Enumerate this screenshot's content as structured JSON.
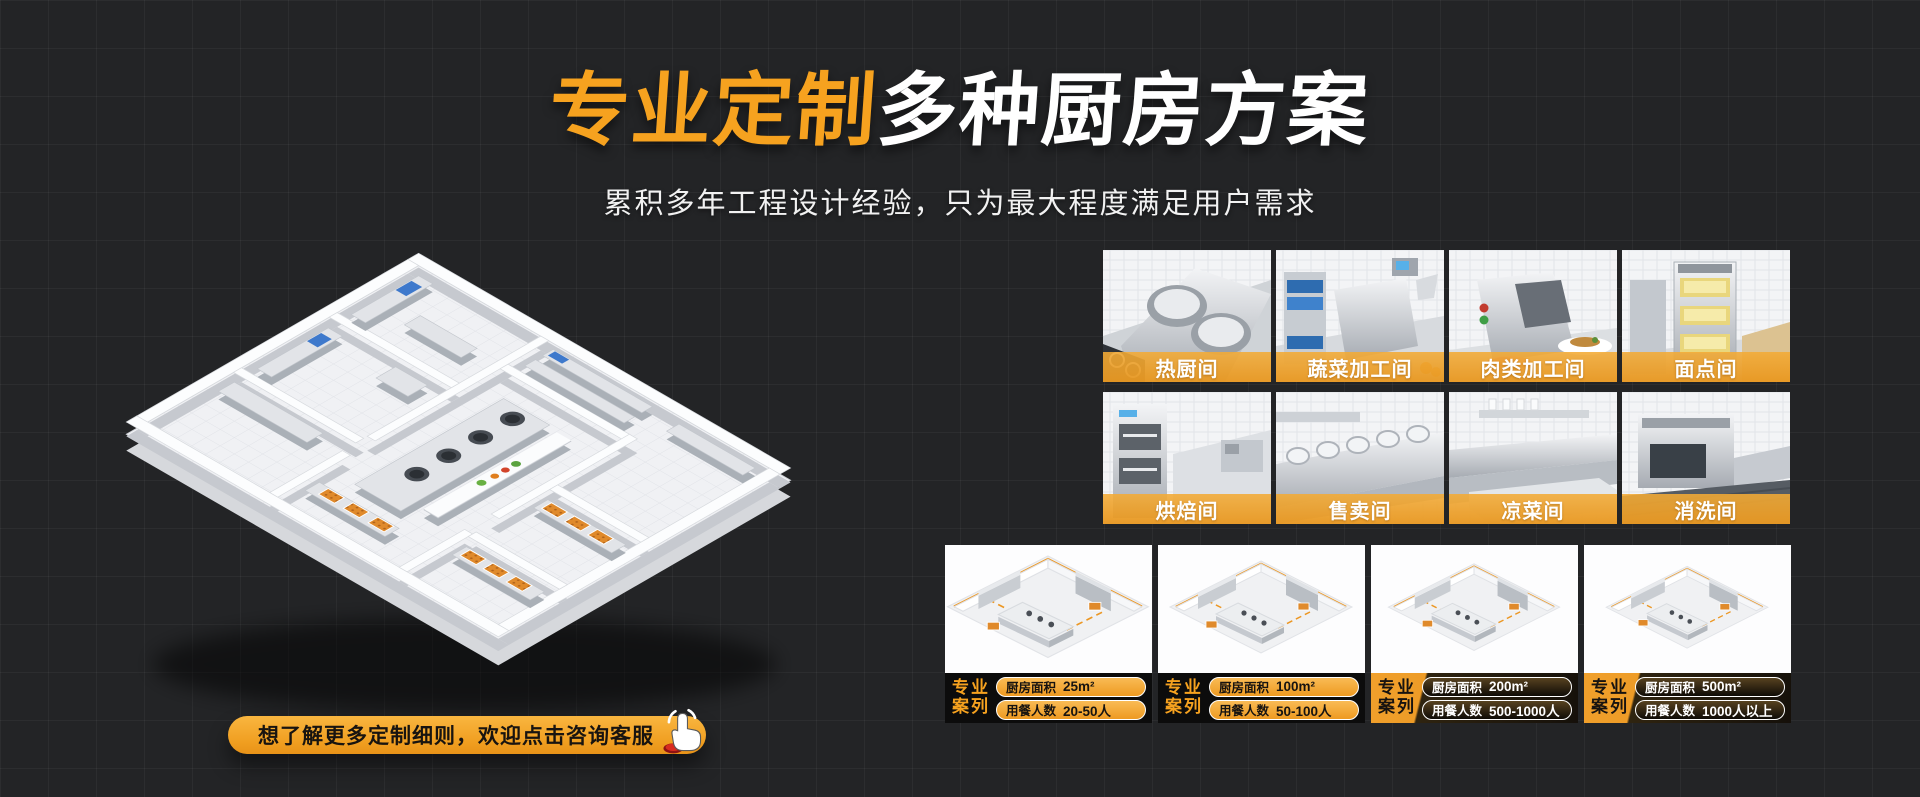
{
  "hero": {
    "title_highlight": "专业定制",
    "title_rest": "多种厨房方案",
    "subtitle": "累积多年工程设计经验，只为最大程度满足用户需求"
  },
  "cta": {
    "label": "想了解更多定制细则，欢迎点击咨询客服",
    "icon": "hand-click-icon"
  },
  "rooms": [
    {
      "label": "热厨间"
    },
    {
      "label": "蔬菜加工间"
    },
    {
      "label": "肉类加工间"
    },
    {
      "label": "面点间"
    },
    {
      "label": "烘焙间"
    },
    {
      "label": "售卖间"
    },
    {
      "label": "凉菜间"
    },
    {
      "label": "消洗间"
    }
  ],
  "cases": {
    "badge_line1": "专业",
    "badge_line2": "案列",
    "area_label": "厨房面积",
    "diners_label": "用餐人数",
    "items": [
      {
        "area": "25m²",
        "diners": "20-50人"
      },
      {
        "area": "100m²",
        "diners": "50-100人"
      },
      {
        "area": "200m²",
        "diners": "500-1000人"
      },
      {
        "area": "500m²",
        "diners": "1000人以上"
      }
    ]
  },
  "colors": {
    "accent_orange": "#F6A21F",
    "band_orange": "#EDA236",
    "background": "#232426",
    "text_light": "#FFFFFF",
    "text_dark": "#111111"
  }
}
